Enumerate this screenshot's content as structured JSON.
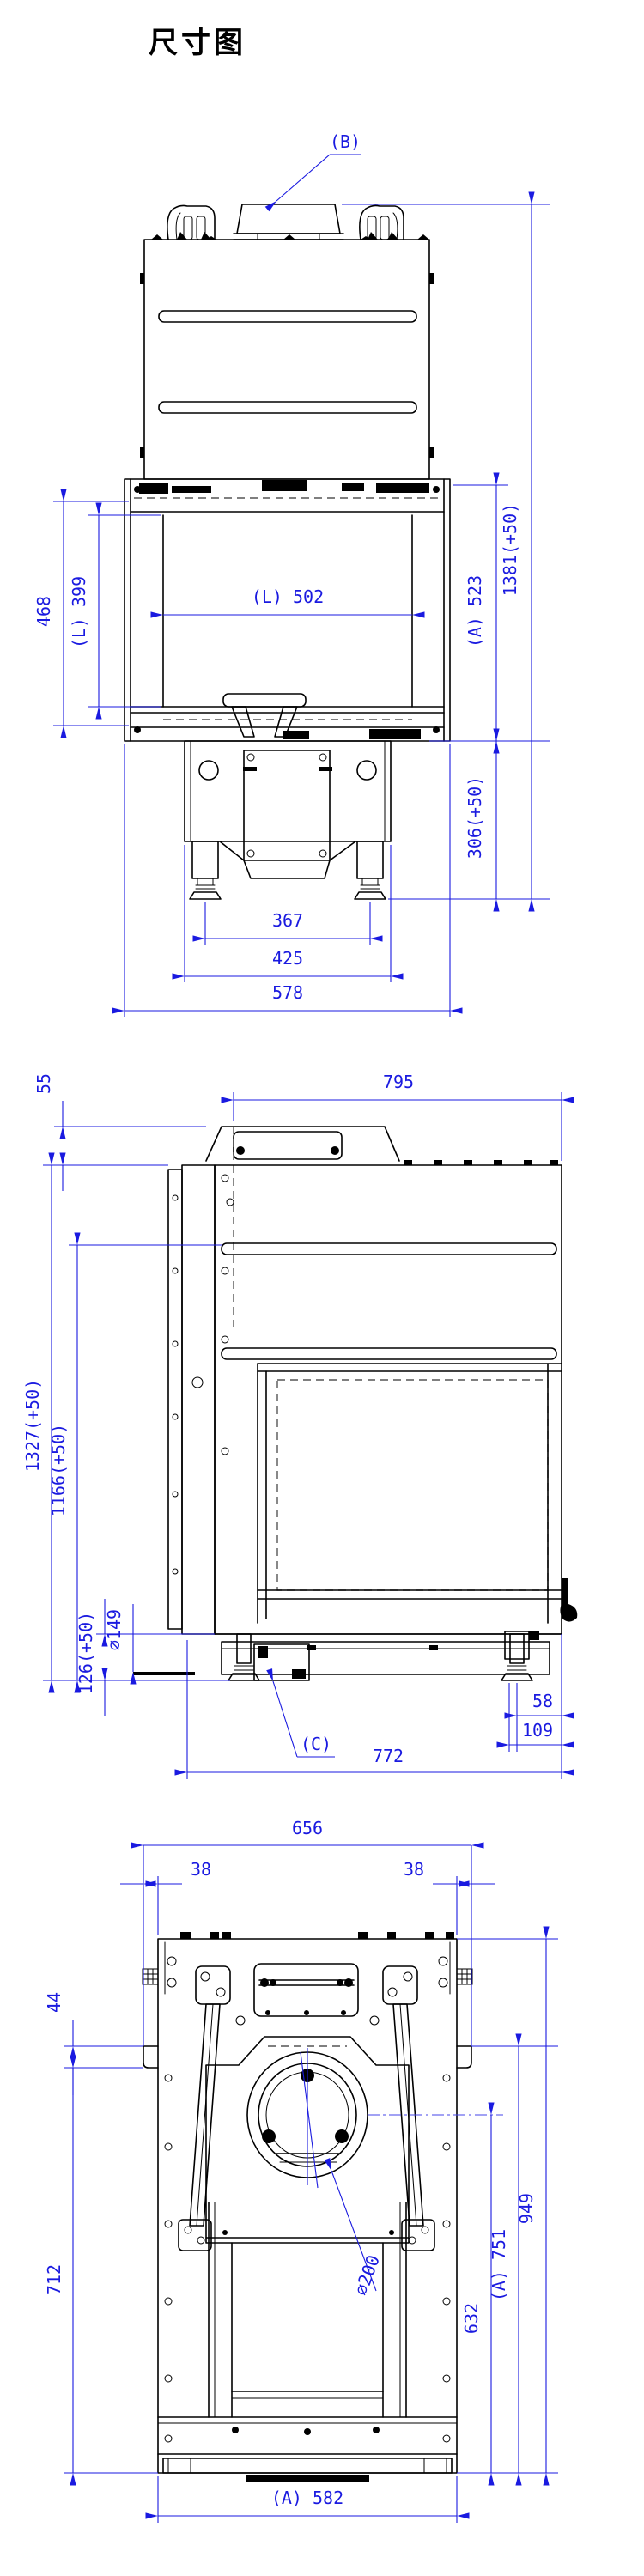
{
  "title": "尺寸图",
  "colors": {
    "dimension": "#1a1ae0",
    "linework": "#000000",
    "background": "#ffffff"
  },
  "views": {
    "front": {
      "name": "front view",
      "labels": {
        "flue_ref": "(B)",
        "total_height": "1381(+50)",
        "firebox_height": "(A) 523",
        "base_height": "306(+50)",
        "opening_outer_height": "468",
        "glass_height": "(L) 399",
        "glass_width": "(L) 502",
        "feet_span": "367",
        "pedestal_width": "425",
        "overall_width": "578"
      }
    },
    "side": {
      "name": "side view",
      "labels": {
        "collar_height": "55",
        "depth_top": "795",
        "total_height": "1327(+50)",
        "vent_height": "1166(+50)",
        "glass_depth": "(L) 656",
        "opening_depth": "696",
        "base_clearance": "126(+50)",
        "inlet_diameter": "∅149",
        "valve_ref": "(C)",
        "foot_offset": "58",
        "foot_edge_offset": "109",
        "overall_depth": "772"
      }
    },
    "bottom": {
      "name": "bottom view",
      "labels": {
        "top_width": "656",
        "tab_left": "38",
        "tab_right": "38",
        "tab_height": "44",
        "body_length": "712",
        "flue_diameter": "∅200",
        "flue_center_offset": "632",
        "length_a": "(A) 751",
        "overall_length": "949",
        "bottom_width": "(A) 582"
      }
    }
  }
}
